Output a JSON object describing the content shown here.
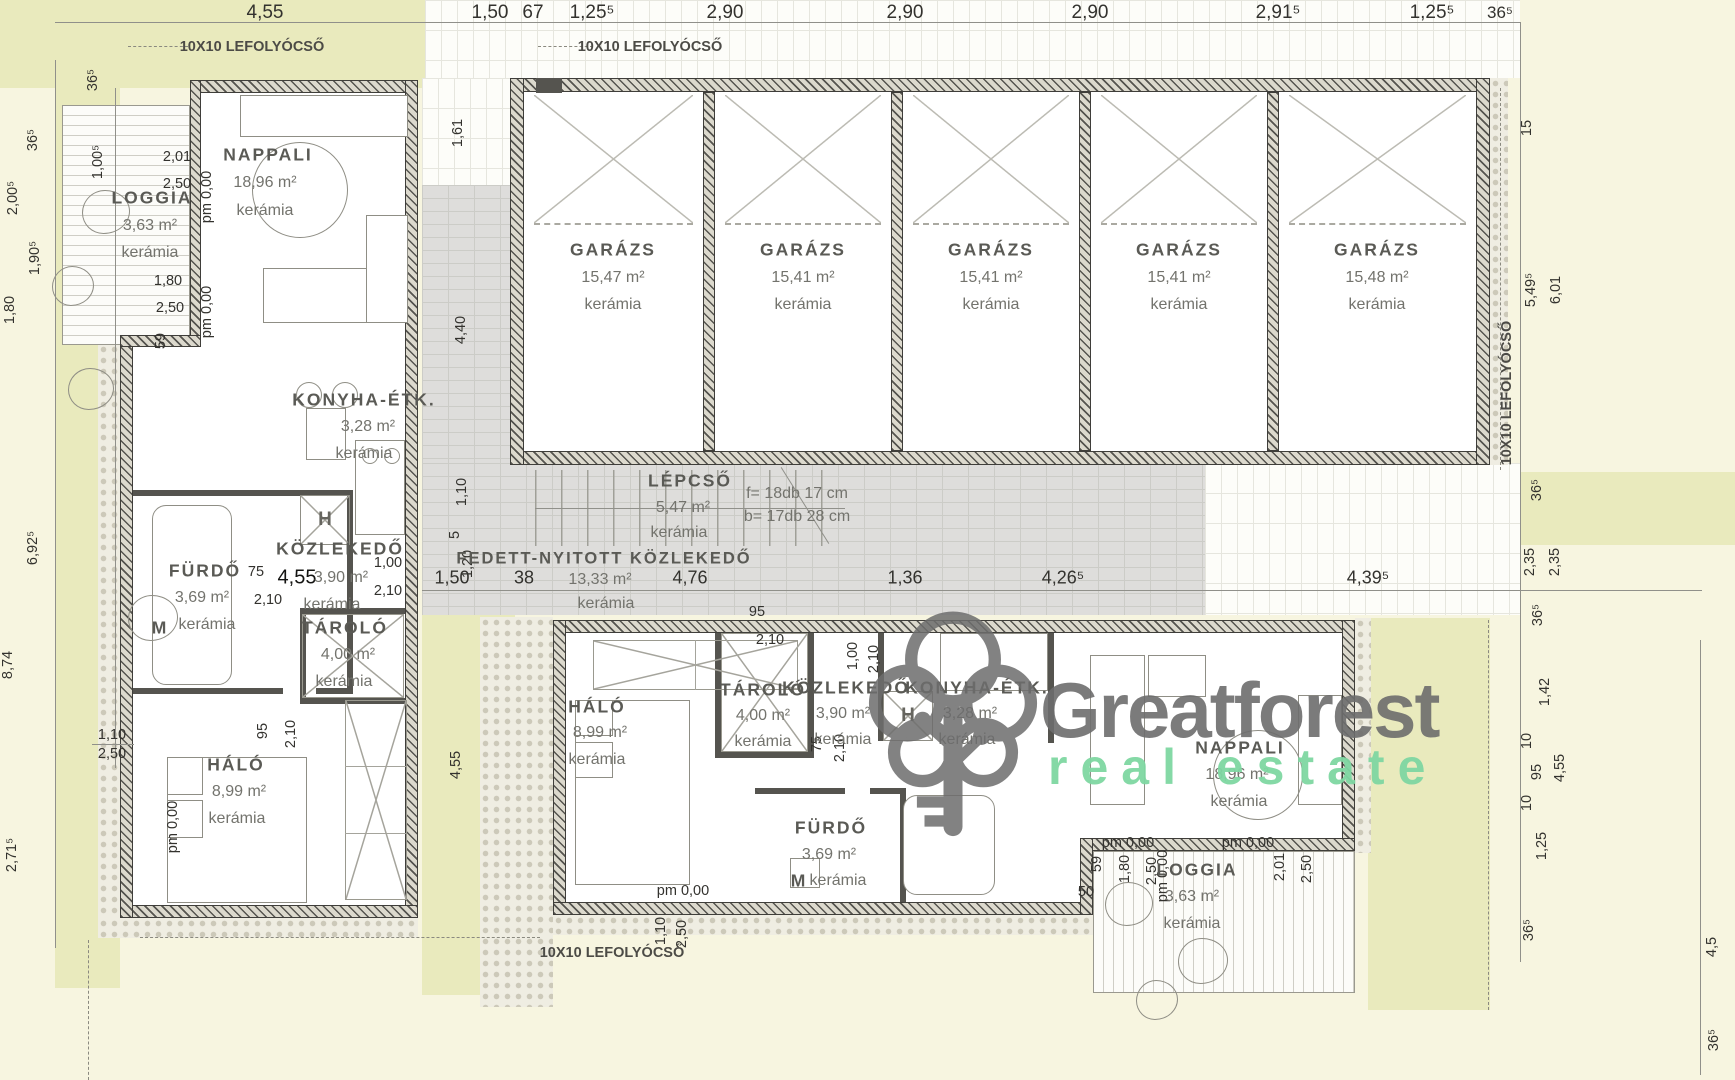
{
  "watermark": {
    "brand": "Greatforest",
    "tagline": "real estate",
    "brand_color": "#6d6d6d",
    "tagline_color": "#7fd7a2"
  },
  "annotations": {
    "drain": "10X10 LEFOLYÓCSŐ",
    "pm": "pm 0,00",
    "m": "M",
    "h": "H"
  },
  "rooms": {
    "apt_top": {
      "loggia": {
        "name": "LOGGIA",
        "area": "3,63 m²",
        "finish": "kerámia"
      },
      "nappali": {
        "name": "NAPPALI",
        "area": "18,96 m²",
        "finish": "kerámia"
      },
      "konyha": {
        "name": "KONYHA-ÉTK.",
        "area": "3,28 m²",
        "finish": "kerámia"
      },
      "kozlekedo": {
        "name": "KÖZLEKEDŐ",
        "area": "3,90 m²",
        "finish": "kerámia"
      },
      "furdo": {
        "name": "FÜRDŐ",
        "area": "3,69 m²",
        "finish": "kerámia"
      },
      "tarolo": {
        "name": "TÁROLÓ",
        "area": "4,00 m²",
        "finish": "kerámia"
      },
      "halo": {
        "name": "HÁLÓ",
        "area": "8,99 m²",
        "finish": "kerámia"
      }
    },
    "apt_bottom": {
      "loggia": {
        "name": "LOGGIA",
        "area": "3,63 m²",
        "finish": "kerámia"
      },
      "nappali": {
        "name": "NAPPALI",
        "area": "18,96 m²",
        "finish": "kerámia"
      },
      "konyha": {
        "name": "KONYHA-ÉTK.",
        "area": "3,28 m²",
        "finish": "kerámia"
      },
      "kozlekedo": {
        "name": "KÖZLEKEDŐ",
        "area": "3,90 m²",
        "finish": "kerámia"
      },
      "furdo": {
        "name": "FÜRDŐ",
        "area": "3,69 m²",
        "finish": "kerámia"
      },
      "tarolo": {
        "name": "TÁROLÓ",
        "area": "4,00 m²",
        "finish": "kerámia"
      },
      "halo": {
        "name": "HÁLÓ",
        "area": "8,99 m²",
        "finish": "kerámia"
      }
    },
    "garages": [
      {
        "name": "GARÁZS",
        "area": "15,47 m²",
        "finish": "kerámia"
      },
      {
        "name": "GARÁZS",
        "area": "15,41 m²",
        "finish": "kerámia"
      },
      {
        "name": "GARÁZS",
        "area": "15,41 m²",
        "finish": "kerámia"
      },
      {
        "name": "GARÁZS",
        "area": "15,41 m²",
        "finish": "kerámia"
      },
      {
        "name": "GARÁZS",
        "area": "15,48 m²",
        "finish": "kerámia"
      }
    ],
    "lepcso": {
      "name": "LÉPCSŐ",
      "area": "5,47 m²",
      "finish": "kerámia",
      "risers": "f= 18db 17 cm",
      "treads": "b= 17db 28 cm"
    },
    "walkway": {
      "name": "FEDETT-NYITOTT KÖZLEKEDŐ",
      "area": "13,33 m²",
      "finish": "kerámia"
    }
  },
  "dims": {
    "top": [
      "4,55",
      "1,50",
      "67",
      "1,25⁵",
      "2,90",
      "2,90",
      "2,90",
      "2,91⁵",
      "1,25⁵",
      "36⁵"
    ],
    "left": [
      "36⁵",
      "36⁵",
      "1,00⁵",
      "2,00⁵",
      "1,90⁵",
      "1,80",
      "6,92⁵",
      "8,74",
      "1,10",
      "2,50",
      "2,71⁵"
    ],
    "right": [
      "15",
      "5,49⁵",
      "6,01",
      "36⁵",
      "2,35",
      "2,35",
      "36⁵",
      "1,42",
      "10",
      "95",
      "4,55",
      "10",
      "1,25",
      "36⁵",
      "4,5",
      "36⁵"
    ],
    "path": [
      "1,61",
      "4,40",
      "1,10",
      "5",
      "1,20",
      "4,55"
    ],
    "row": [
      "1,50",
      "38",
      "4,76",
      "1,36",
      "4,26⁵",
      "4,39⁵"
    ],
    "apt_top": [
      "2,01",
      "2,50",
      "1,80",
      "2,50",
      "59",
      "75",
      "4,55",
      "2,10",
      "1,00",
      "2,10",
      "95",
      "2,10"
    ],
    "apt_bottom": [
      "95",
      "2,10",
      "1,00",
      "2,10",
      "75",
      "2,10",
      "1,10",
      "2,50",
      "59",
      "1,80",
      "2,50",
      "2,01",
      "2,50",
      "50"
    ]
  }
}
